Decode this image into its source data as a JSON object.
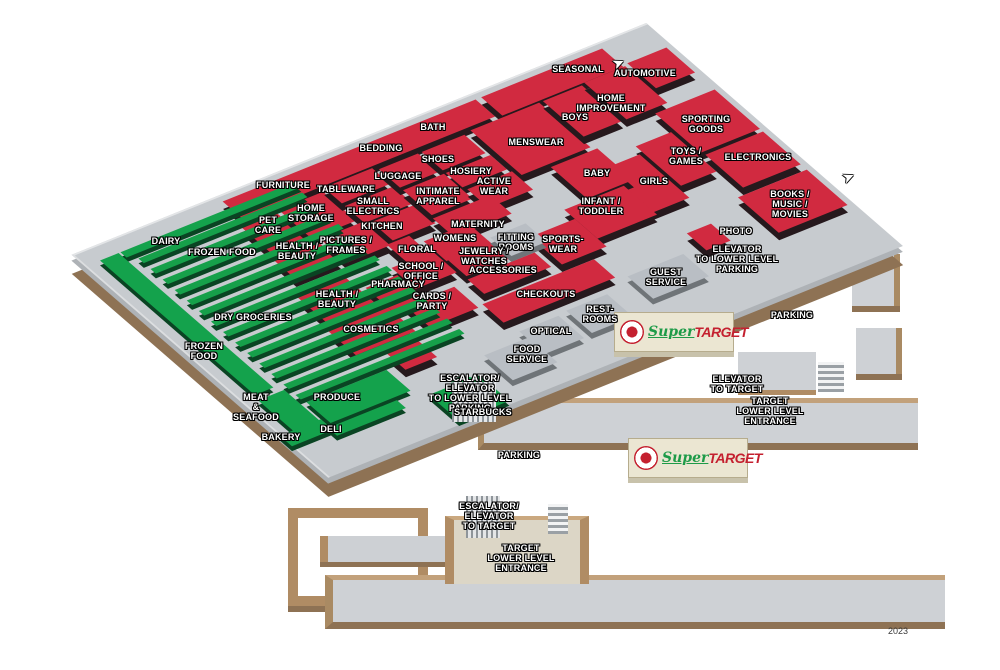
{
  "map": {
    "year": "2023",
    "brand": {
      "super_word": "Super",
      "target_word": "TARGET"
    },
    "colors": {
      "department_red": "#d12a40",
      "grocery_green": "#14a24c",
      "floor_gray": "#c7cbcf",
      "service_gray": "#b9bec4",
      "curb_tan": "#c2a17b",
      "edge_brown": "#8e7254",
      "target_red": "#c4202f",
      "super_green": "#1d9b48"
    },
    "aisle_count": 14,
    "blocks": [
      {
        "id": "furniture-bedding-bath",
        "c": "red",
        "u": 148,
        "v": 0,
        "w": 272,
        "h": 26
      },
      {
        "id": "seasonal",
        "c": "red",
        "u": 426,
        "v": 0,
        "w": 130,
        "h": 28
      },
      {
        "id": "automotive",
        "c": "red",
        "u": 562,
        "v": 26,
        "w": 42,
        "h": 38
      },
      {
        "id": "pet-care",
        "c": "red",
        "u": 140,
        "v": 32,
        "w": 38,
        "h": 44
      },
      {
        "id": "home-storage",
        "c": "red",
        "u": 182,
        "v": 32,
        "w": 48,
        "h": 44
      },
      {
        "id": "tableware",
        "c": "red",
        "u": 234,
        "v": 28,
        "w": 52,
        "h": 24
      },
      {
        "id": "small-electrics",
        "c": "red",
        "u": 234,
        "v": 56,
        "w": 52,
        "h": 26
      },
      {
        "id": "luggage",
        "c": "red",
        "u": 290,
        "v": 32,
        "w": 42,
        "h": 28
      },
      {
        "id": "shoes",
        "c": "red",
        "u": 336,
        "v": 32,
        "w": 46,
        "h": 28
      },
      {
        "id": "hosiery",
        "c": "red",
        "u": 336,
        "v": 64,
        "w": 48,
        "h": 22
      },
      {
        "id": "menswear",
        "c": "red",
        "u": 390,
        "v": 30,
        "w": 74,
        "h": 68
      },
      {
        "id": "boys",
        "c": "red",
        "u": 468,
        "v": 30,
        "w": 42,
        "h": 54
      },
      {
        "id": "home-improvement",
        "c": "red",
        "u": 514,
        "v": 28,
        "w": 44,
        "h": 56
      },
      {
        "id": "sporting-goods",
        "c": "red",
        "u": 540,
        "v": 90,
        "w": 64,
        "h": 60
      },
      {
        "id": "toys-games",
        "c": "red",
        "u": 498,
        "v": 116,
        "w": 38,
        "h": 60
      },
      {
        "id": "electronics",
        "c": "red",
        "u": 542,
        "v": 154,
        "w": 62,
        "h": 50
      },
      {
        "id": "girls",
        "c": "red",
        "u": 452,
        "v": 126,
        "w": 42,
        "h": 66
      },
      {
        "id": "baby",
        "c": "red",
        "u": 418,
        "v": 102,
        "w": 50,
        "h": 48
      },
      {
        "id": "infant-toddler",
        "c": "red",
        "u": 392,
        "v": 152,
        "w": 64,
        "h": 44
      },
      {
        "id": "books-music-movies",
        "c": "red",
        "u": 530,
        "v": 212,
        "w": 74,
        "h": 54
      },
      {
        "id": "photo-kiosk",
        "c": "red",
        "u": 462,
        "v": 228,
        "w": 26,
        "h": 26
      },
      {
        "id": "health-beauty-1",
        "c": "red",
        "u": 136,
        "v": 80,
        "w": 48,
        "h": 32
      },
      {
        "id": "pictures-frames",
        "c": "red",
        "u": 188,
        "v": 80,
        "w": 48,
        "h": 36
      },
      {
        "id": "kitchen",
        "c": "red",
        "u": 240,
        "v": 84,
        "w": 46,
        "h": 28
      },
      {
        "id": "intimate-apparel",
        "c": "red",
        "u": 290,
        "v": 64,
        "w": 44,
        "h": 38
      },
      {
        "id": "active-wear",
        "c": "red",
        "u": 338,
        "v": 90,
        "w": 48,
        "h": 28
      },
      {
        "id": "maternity",
        "c": "red",
        "u": 288,
        "v": 106,
        "w": 62,
        "h": 28
      },
      {
        "id": "womens",
        "c": "red",
        "u": 262,
        "v": 126,
        "w": 48,
        "h": 30
      },
      {
        "id": "floral",
        "c": "red",
        "u": 232,
        "v": 114,
        "w": 24,
        "h": 40
      },
      {
        "id": "sportswear",
        "c": "red",
        "u": 344,
        "v": 166,
        "w": 48,
        "h": 42
      },
      {
        "id": "jewelry-watches",
        "c": "red",
        "u": 264,
        "v": 152,
        "w": 46,
        "h": 28
      },
      {
        "id": "accessories",
        "c": "red",
        "u": 262,
        "v": 184,
        "w": 72,
        "h": 22
      },
      {
        "id": "school-office",
        "c": "red",
        "u": 216,
        "v": 140,
        "w": 44,
        "h": 32
      },
      {
        "id": "pharmacy",
        "c": "red",
        "u": 180,
        "v": 150,
        "w": 34,
        "h": 38
      },
      {
        "id": "cards-party",
        "c": "red",
        "u": 194,
        "v": 186,
        "w": 52,
        "h": 32
      },
      {
        "id": "health-beauty-2",
        "c": "red",
        "u": 122,
        "v": 130,
        "w": 52,
        "h": 40
      },
      {
        "id": "cosmetics",
        "c": "red",
        "u": 116,
        "v": 176,
        "w": 64,
        "h": 40
      },
      {
        "id": "kiosk-small",
        "c": "red",
        "u": 140,
        "v": 226,
        "w": 34,
        "h": 26
      },
      {
        "id": "checkouts",
        "c": "red",
        "u": 252,
        "v": 216,
        "w": 120,
        "h": 28
      },
      {
        "id": "fitting-rooms",
        "c": "gray",
        "u": 314,
        "v": 150,
        "w": 38,
        "h": 28
      },
      {
        "id": "guest-service",
        "c": "gray",
        "u": 382,
        "v": 248,
        "w": 60,
        "h": 34
      },
      {
        "id": "restrooms",
        "c": "gray",
        "u": 308,
        "v": 258,
        "w": 44,
        "h": 34
      },
      {
        "id": "optical",
        "c": "gray",
        "u": 256,
        "v": 260,
        "w": 42,
        "h": 34
      },
      {
        "id": "food-service",
        "c": "gray",
        "u": 210,
        "v": 270,
        "w": 48,
        "h": 38
      },
      {
        "id": "dairy-aisle",
        "c": "green",
        "u": 30,
        "v": 10,
        "w": 188,
        "h": 8
      },
      {
        "id": "left-band",
        "c": "green",
        "u": 8,
        "v": 10,
        "w": 20,
        "h": 205
      },
      {
        "id": "meat-seafood",
        "c": "green",
        "u": 6,
        "v": 222,
        "w": 28,
        "h": 50
      },
      {
        "id": "produce",
        "c": "green",
        "u": 40,
        "v": 244,
        "w": 86,
        "h": 32
      },
      {
        "id": "deli",
        "c": "green",
        "u": 34,
        "v": 280,
        "w": 74,
        "h": 12
      },
      {
        "id": "bakery",
        "c": "green",
        "u": -8,
        "v": 268,
        "w": 44,
        "h": 16
      },
      {
        "id": "starbucks",
        "c": "green",
        "u": 136,
        "v": 288,
        "w": 54,
        "h": 40
      },
      {
        "id": "starbucks-kiosk",
        "c": "green round",
        "u": 158,
        "v": 282,
        "w": 26,
        "h": 26
      }
    ],
    "labels": [
      {
        "t": "DAIRY",
        "x": 166,
        "y": 242
      },
      {
        "t": "FROZEN FOOD",
        "x": 222,
        "y": 253
      },
      {
        "t": "PET\nCARE",
        "x": 268,
        "y": 226
      },
      {
        "t": "HOME\nSTORAGE",
        "x": 311,
        "y": 214
      },
      {
        "t": "FURNITURE",
        "x": 283,
        "y": 186
      },
      {
        "t": "TABLEWARE",
        "x": 346,
        "y": 190
      },
      {
        "t": "SMALL\nELECTRICS",
        "x": 373,
        "y": 207
      },
      {
        "t": "BEDDING",
        "x": 381,
        "y": 149
      },
      {
        "t": "BATH",
        "x": 433,
        "y": 128
      },
      {
        "t": "SHOES",
        "x": 438,
        "y": 160
      },
      {
        "t": "LUGGAGE",
        "x": 398,
        "y": 177
      },
      {
        "t": "HOSIERY",
        "x": 471,
        "y": 172
      },
      {
        "t": "ACTIVE\nWEAR",
        "x": 494,
        "y": 187
      },
      {
        "t": "INTIMATE\nAPPAREL",
        "x": 438,
        "y": 197
      },
      {
        "t": "MENSWEAR",
        "x": 536,
        "y": 143
      },
      {
        "t": "SEASONAL",
        "x": 578,
        "y": 70
      },
      {
        "t": "AUTOMOTIVE",
        "x": 645,
        "y": 74
      },
      {
        "t": "HOME\nIMPROVEMENT",
        "x": 611,
        "y": 104
      },
      {
        "t": "BOYS",
        "x": 575,
        "y": 118
      },
      {
        "t": "SPORTING\nGOODS",
        "x": 706,
        "y": 125
      },
      {
        "t": "TOYS /\nGAMES",
        "x": 686,
        "y": 157
      },
      {
        "t": "ELECTRONICS",
        "x": 758,
        "y": 158
      },
      {
        "t": "BABY",
        "x": 597,
        "y": 174
      },
      {
        "t": "GIRLS",
        "x": 654,
        "y": 182
      },
      {
        "t": "INFANT /\nTODDLER",
        "x": 601,
        "y": 207
      },
      {
        "t": "BOOKS /\nMUSIC /\nMOVIES",
        "x": 790,
        "y": 205
      },
      {
        "t": "MATERNITY",
        "x": 478,
        "y": 225
      },
      {
        "t": "KITCHEN",
        "x": 382,
        "y": 227
      },
      {
        "t": "WOMENS",
        "x": 455,
        "y": 239
      },
      {
        "t": "FITTING\nROOMS",
        "x": 516,
        "y": 243
      },
      {
        "t": "SPORTS-\nWEAR",
        "x": 563,
        "y": 245
      },
      {
        "t": "PHOTO",
        "x": 736,
        "y": 232
      },
      {
        "t": "ELEVATOR\nTO LOWER LEVEL\nPARKING",
        "x": 737,
        "y": 260
      },
      {
        "t": "PICTURES /\nFRAMES",
        "x": 346,
        "y": 246
      },
      {
        "t": "HEALTH /\nBEAUTY",
        "x": 297,
        "y": 252
      },
      {
        "t": "FLORAL",
        "x": 417,
        "y": 250
      },
      {
        "t": "JEWELRY /\nWATCHES",
        "x": 484,
        "y": 257
      },
      {
        "t": "SCHOOL /\nOFFICE",
        "x": 421,
        "y": 272
      },
      {
        "t": "ACCESSORIES",
        "x": 503,
        "y": 271
      },
      {
        "t": "PHARMACY",
        "x": 398,
        "y": 285
      },
      {
        "t": "HEALTH /\nBEAUTY",
        "x": 337,
        "y": 300
      },
      {
        "t": "CARDS /\nPARTY",
        "x": 432,
        "y": 302
      },
      {
        "t": "CHECKOUTS",
        "x": 546,
        "y": 295
      },
      {
        "t": "GUEST\nSERVICE",
        "x": 666,
        "y": 278
      },
      {
        "t": "DRY GROCERIES",
        "x": 253,
        "y": 318
      },
      {
        "t": "REST-\nROOMS",
        "x": 600,
        "y": 315
      },
      {
        "t": "COSMETICS",
        "x": 371,
        "y": 330
      },
      {
        "t": "OPTICAL",
        "x": 551,
        "y": 332
      },
      {
        "t": "FROZEN\nFOOD",
        "x": 204,
        "y": 352
      },
      {
        "t": "FOOD\nSERVICE",
        "x": 527,
        "y": 355
      },
      {
        "t": "PARKING",
        "x": 792,
        "y": 316
      },
      {
        "t": "ESCALATOR/\nELEVATOR\nTO LOWER LEVEL\nPARKING",
        "x": 470,
        "y": 394
      },
      {
        "t": "ELEVATOR\nTO TARGET",
        "x": 737,
        "y": 385
      },
      {
        "t": "TARGET\nLOWER LEVEL\nENTRANCE",
        "x": 770,
        "y": 412
      },
      {
        "t": "MEAT\n&\nSEAFOOD",
        "x": 256,
        "y": 408
      },
      {
        "t": "PRODUCE",
        "x": 337,
        "y": 398
      },
      {
        "t": "STARBUCKS",
        "x": 483,
        "y": 413
      },
      {
        "t": "DELI",
        "x": 331,
        "y": 430
      },
      {
        "t": "BAKERY",
        "x": 281,
        "y": 438
      },
      {
        "t": "PARKING",
        "x": 519,
        "y": 456
      },
      {
        "t": "ESCALATOR/\nELEVATOR\nTO TARGET",
        "x": 489,
        "y": 517
      },
      {
        "t": "TARGET\nLOWER LEVEL\nENTRANCE",
        "x": 521,
        "y": 559
      }
    ],
    "arrows": [
      {
        "glyph": "➤",
        "x": 612,
        "y": 54,
        "rot": -23
      },
      {
        "glyph": "➤",
        "x": 842,
        "y": 168,
        "rot": -23
      }
    ]
  }
}
